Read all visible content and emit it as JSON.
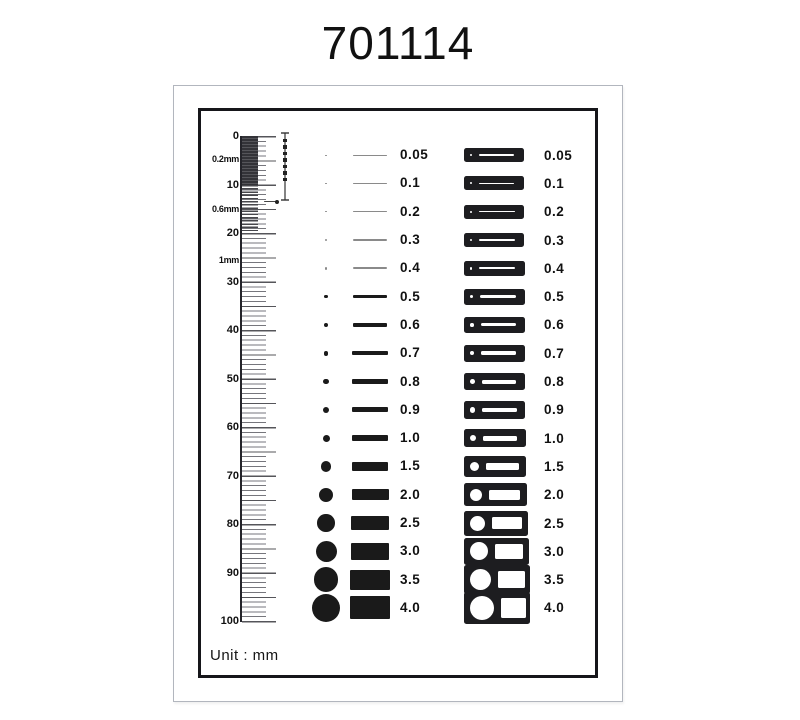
{
  "title": "701114",
  "unit_label": "Unit : mm",
  "colors": {
    "ink": "#1a1a1a",
    "faint_line": "#8a8a8a",
    "chip_bg": "#1d1d20",
    "outer_frame": "#b2b6be",
    "inner_frame": "#16161a"
  },
  "ruler": {
    "min": 0,
    "max": 100,
    "minor_step": 1,
    "major_step": 5,
    "labels": [
      {
        "text": "0",
        "u": 0,
        "kind": "major"
      },
      {
        "text": "0.2mm",
        "u": 4.7,
        "kind": "pitch"
      },
      {
        "text": "10",
        "u": 10,
        "kind": "major"
      },
      {
        "text": "0.6mm",
        "u": 15,
        "kind": "pitch"
      },
      {
        "text": "20",
        "u": 20,
        "kind": "major"
      },
      {
        "text": "1mm",
        "u": 25.5,
        "kind": "pitch"
      },
      {
        "text": "30",
        "u": 30,
        "kind": "major"
      },
      {
        "text": "40",
        "u": 40,
        "kind": "major"
      },
      {
        "text": "50",
        "u": 50,
        "kind": "major"
      },
      {
        "text": "60",
        "u": 60,
        "kind": "major"
      },
      {
        "text": "70",
        "u": 70,
        "kind": "major"
      },
      {
        "text": "80",
        "u": 80,
        "kind": "major"
      },
      {
        "text": "90",
        "u": 90,
        "kind": "major"
      },
      {
        "text": "100",
        "u": 100,
        "kind": "major"
      }
    ]
  },
  "rows": [
    {
      "value": "0.05",
      "mm": 0.05
    },
    {
      "value": "0.1",
      "mm": 0.1
    },
    {
      "value": "0.2",
      "mm": 0.2
    },
    {
      "value": "0.3",
      "mm": 0.3
    },
    {
      "value": "0.4",
      "mm": 0.4
    },
    {
      "value": "0.5",
      "mm": 0.5
    },
    {
      "value": "0.6",
      "mm": 0.6
    },
    {
      "value": "0.7",
      "mm": 0.7
    },
    {
      "value": "0.8",
      "mm": 0.8
    },
    {
      "value": "0.9",
      "mm": 0.9
    },
    {
      "value": "1.0",
      "mm": 1.0
    },
    {
      "value": "1.5",
      "mm": 1.5
    },
    {
      "value": "2.0",
      "mm": 2.0
    },
    {
      "value": "2.5",
      "mm": 2.5
    },
    {
      "value": "3.0",
      "mm": 3.0
    },
    {
      "value": "3.5",
      "mm": 3.5
    },
    {
      "value": "4.0",
      "mm": 4.0
    }
  ]
}
